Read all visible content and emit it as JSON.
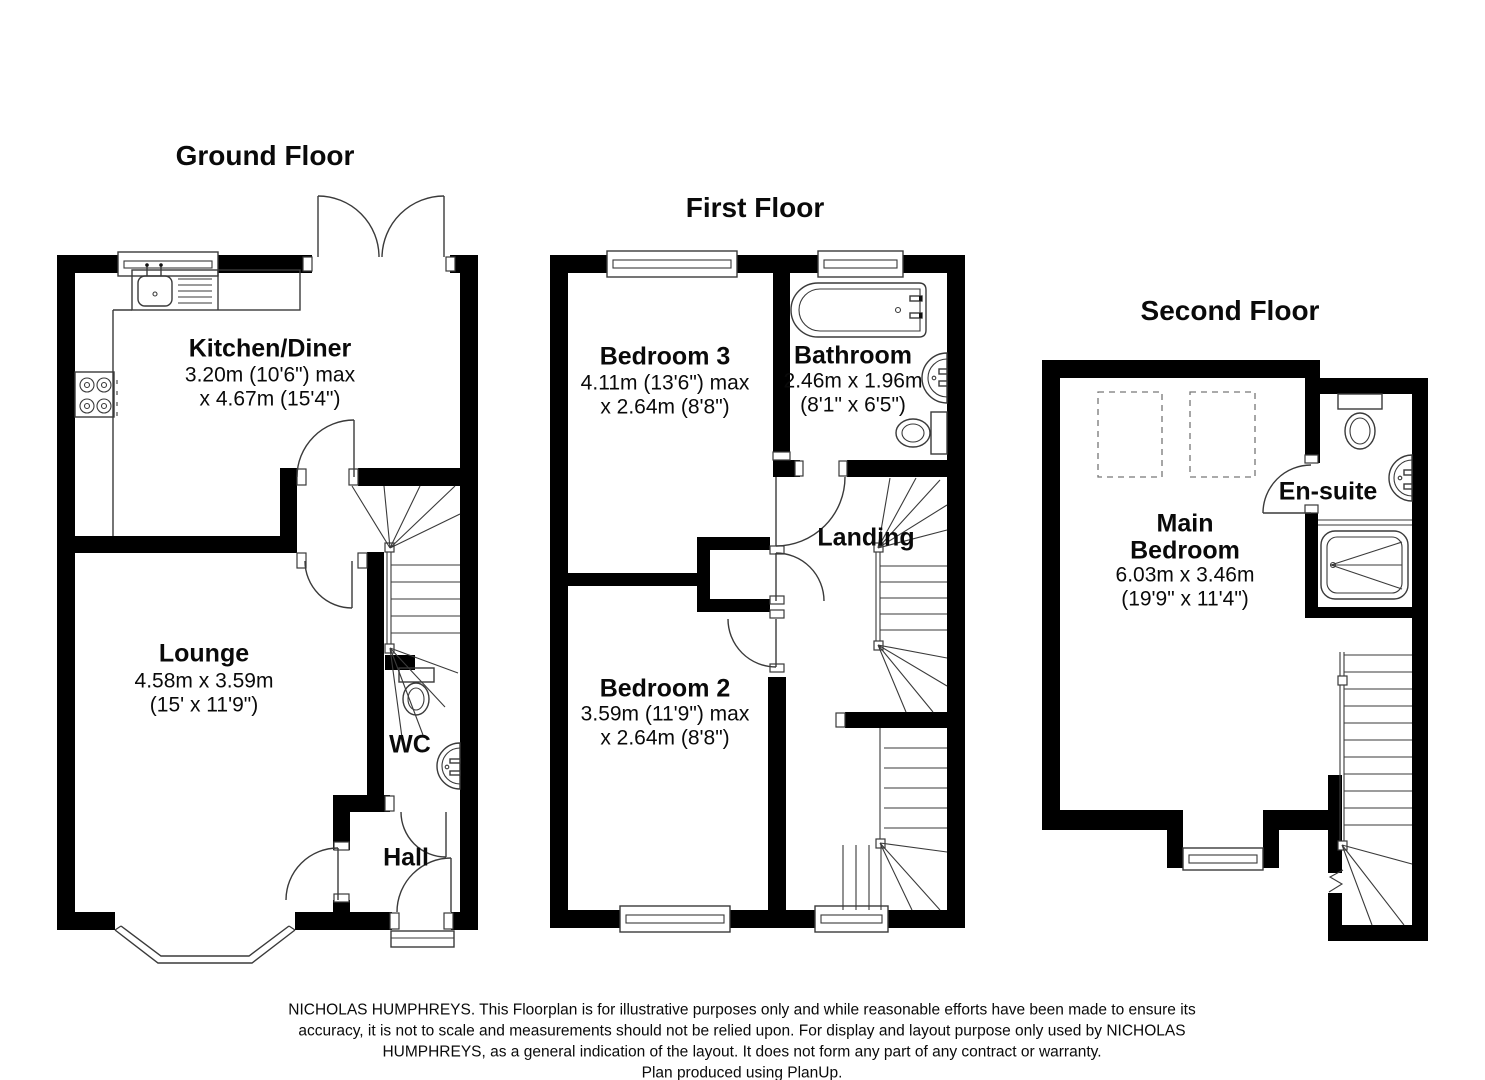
{
  "app": {
    "type": "floorplan",
    "background": "#ffffff",
    "wall_color": "#000000",
    "line_color": "#3a3a3a",
    "text_color": "#0a0a0a"
  },
  "floors": {
    "ground": {
      "title": "Ground Floor",
      "kitchen_name": "Kitchen/Diner",
      "kitchen_dim1": "3.20m (10'6\") max",
      "kitchen_dim2": "x 4.67m (15'4\")",
      "lounge_name": "Lounge",
      "lounge_dim1": "4.58m x 3.59m",
      "lounge_dim2": "(15' x 11'9\")",
      "wc_name": "WC",
      "hall_name": "Hall"
    },
    "first": {
      "title": "First Floor",
      "bedroom3_name": "Bedroom 3",
      "bedroom3_dim1": "4.11m (13'6\") max",
      "bedroom3_dim2": "x 2.64m (8'8\")",
      "bathroom_name": "Bathroom",
      "bathroom_dim1": "2.46m x 1.96m",
      "bathroom_dim2": "(8'1\" x 6'5\")",
      "landing_name": "Landing",
      "bedroom2_name": "Bedroom 2",
      "bedroom2_dim1": "3.59m (11'9\") max",
      "bedroom2_dim2": "x 2.64m (8'8\")"
    },
    "second": {
      "title": "Second Floor",
      "main_bedroom_name_line1": "Main",
      "main_bedroom_name_line2": "Bedroom",
      "main_bedroom_dim1": "6.03m x 3.46m",
      "main_bedroom_dim2": "(19'9\" x 11'4\")",
      "ensuite_name": "En-suite"
    }
  },
  "footer": {
    "line1": "NICHOLAS HUMPHREYS. This Floorplan is for illustrative purposes only and while reasonable efforts have been made to ensure its",
    "line2": "accuracy, it is not to scale and measurements should not be relied upon. For display and layout purpose only used by NICHOLAS",
    "line3": "HUMPHREYS, as a general indication of the layout. It does not form any part of any contract or warranty.",
    "line4": "Plan produced using PlanUp."
  }
}
